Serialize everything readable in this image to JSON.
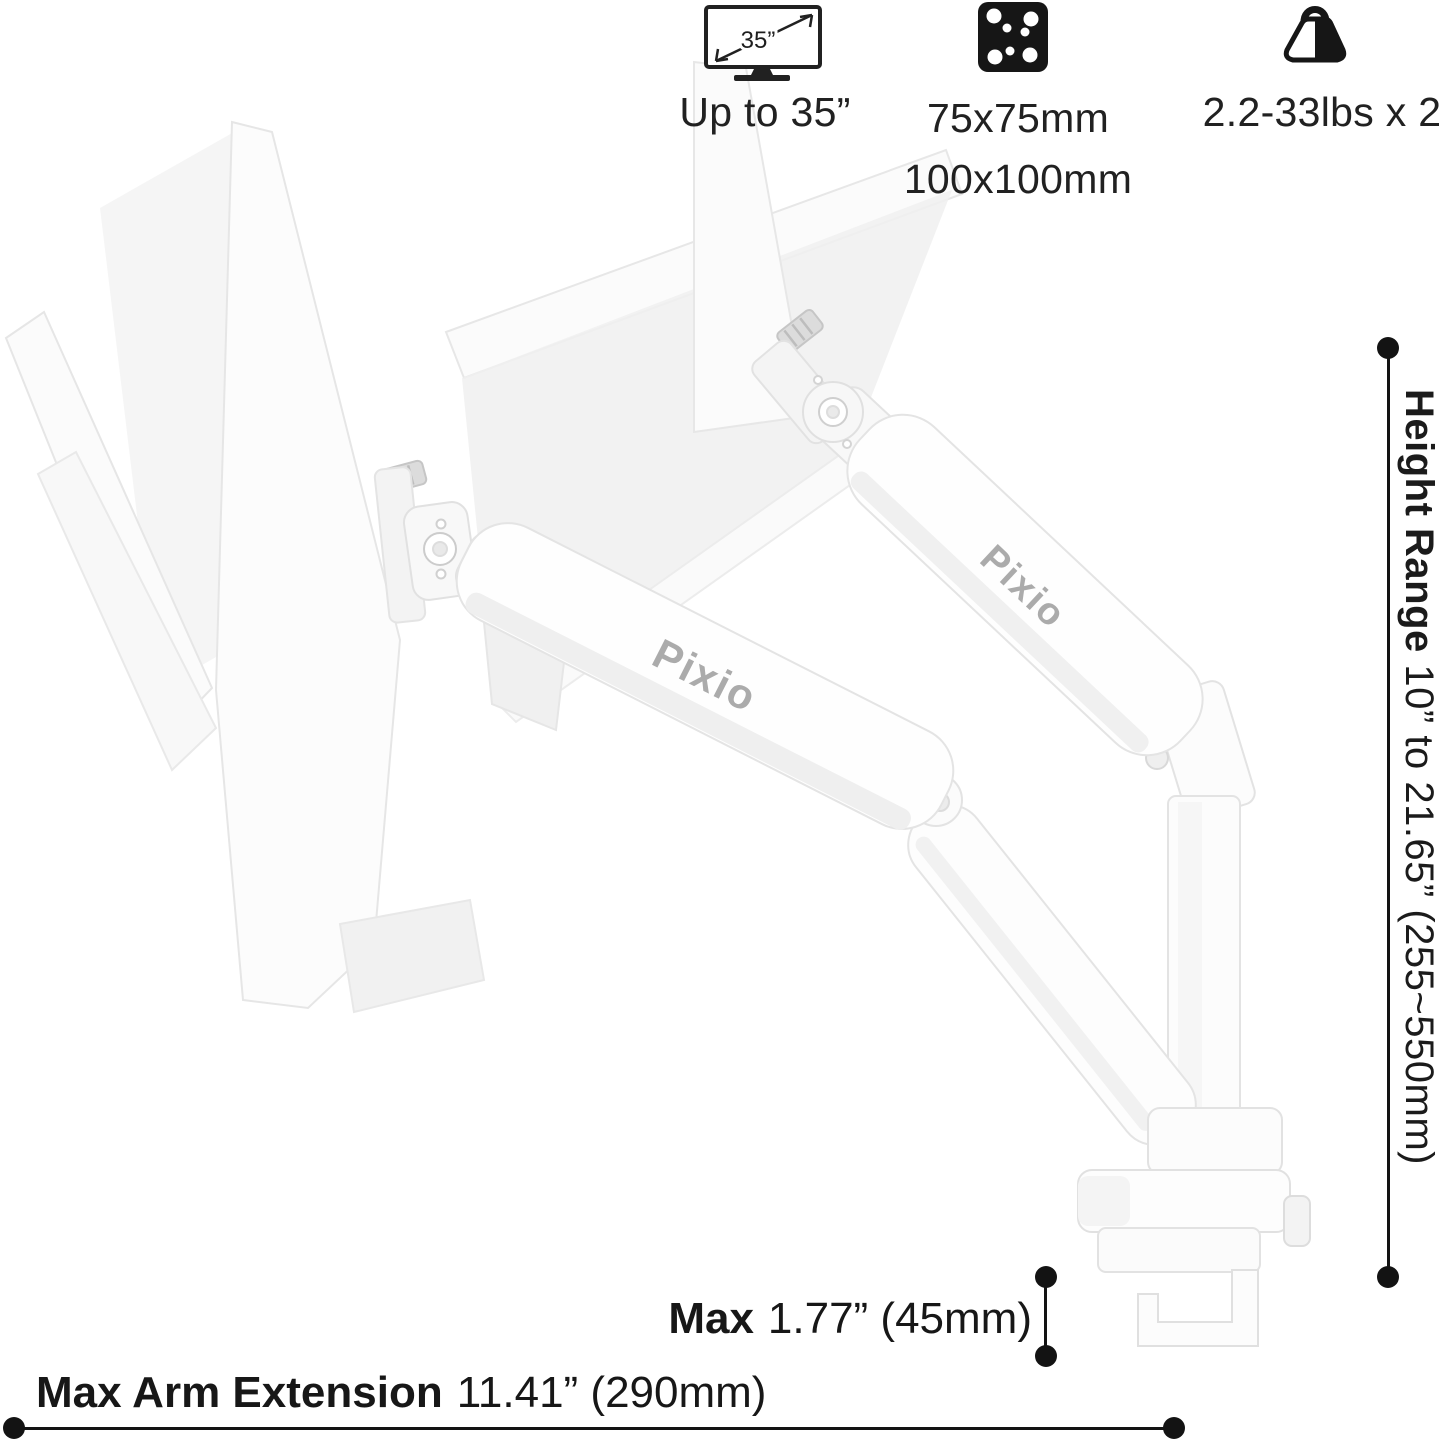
{
  "colors": {
    "ink": "#131313",
    "label_text": "#212121",
    "logo_gray": "#ababab",
    "icon_black": "#161616",
    "product_white": "#fcfcfc",
    "product_stroke": "#e4e4e4"
  },
  "header_specs": {
    "screen": {
      "icon_text": "35”",
      "label": "Up to 35”"
    },
    "vesa": {
      "line1": "75x75mm",
      "line2": "100x100mm"
    },
    "load": {
      "label": "2.2-33lbs x 2"
    }
  },
  "dimensions": {
    "height_range": {
      "bold": "Height Range",
      "value": "10” to 21.65” (255~550mm)"
    },
    "clamp": {
      "bold": "Max",
      "value": "1.77” (45mm)"
    },
    "extension": {
      "bold": "Max Arm Extension",
      "value": "11.41” (290mm)"
    }
  },
  "product": {
    "brand_front": "Pixio",
    "brand_rear": "Pixio"
  }
}
